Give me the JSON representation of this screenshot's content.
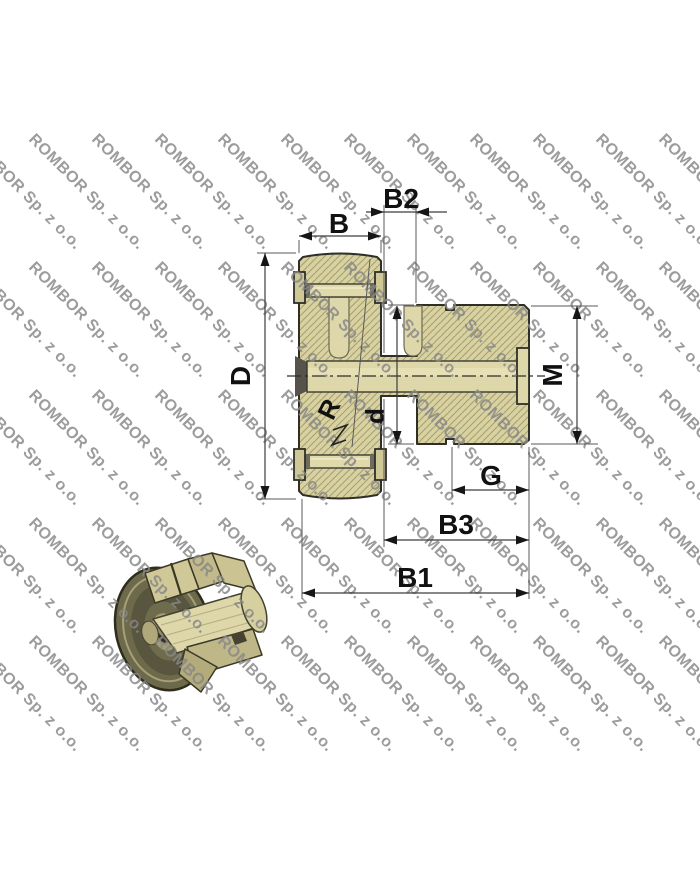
{
  "watermark": {
    "text": "ROMBOR Sp. z o.o.",
    "angle": 45,
    "rows_y": [
      140,
      268,
      396,
      524,
      642
    ],
    "col_start": -35,
    "col_step": 63,
    "cols": 12
  },
  "dims": {
    "b": "B",
    "b2": "B2",
    "d_outer": "D",
    "d_inner": "d",
    "radius": "R",
    "thread": "M",
    "g": "G",
    "b3": "B3",
    "b1": "B1"
  },
  "colors": {
    "part-fill": "#d8d1a2",
    "hatch-line": "#a89f6e",
    "outline": "#2f2f28",
    "dim-line": "#3d3d3d",
    "label": "#111111",
    "watermark": "#878787",
    "bore": "#ded7aa",
    "bg": "#ffffff",
    "render-dark-olive": "#6d6a4c",
    "render-light-khaki": "#d2ca99"
  }
}
